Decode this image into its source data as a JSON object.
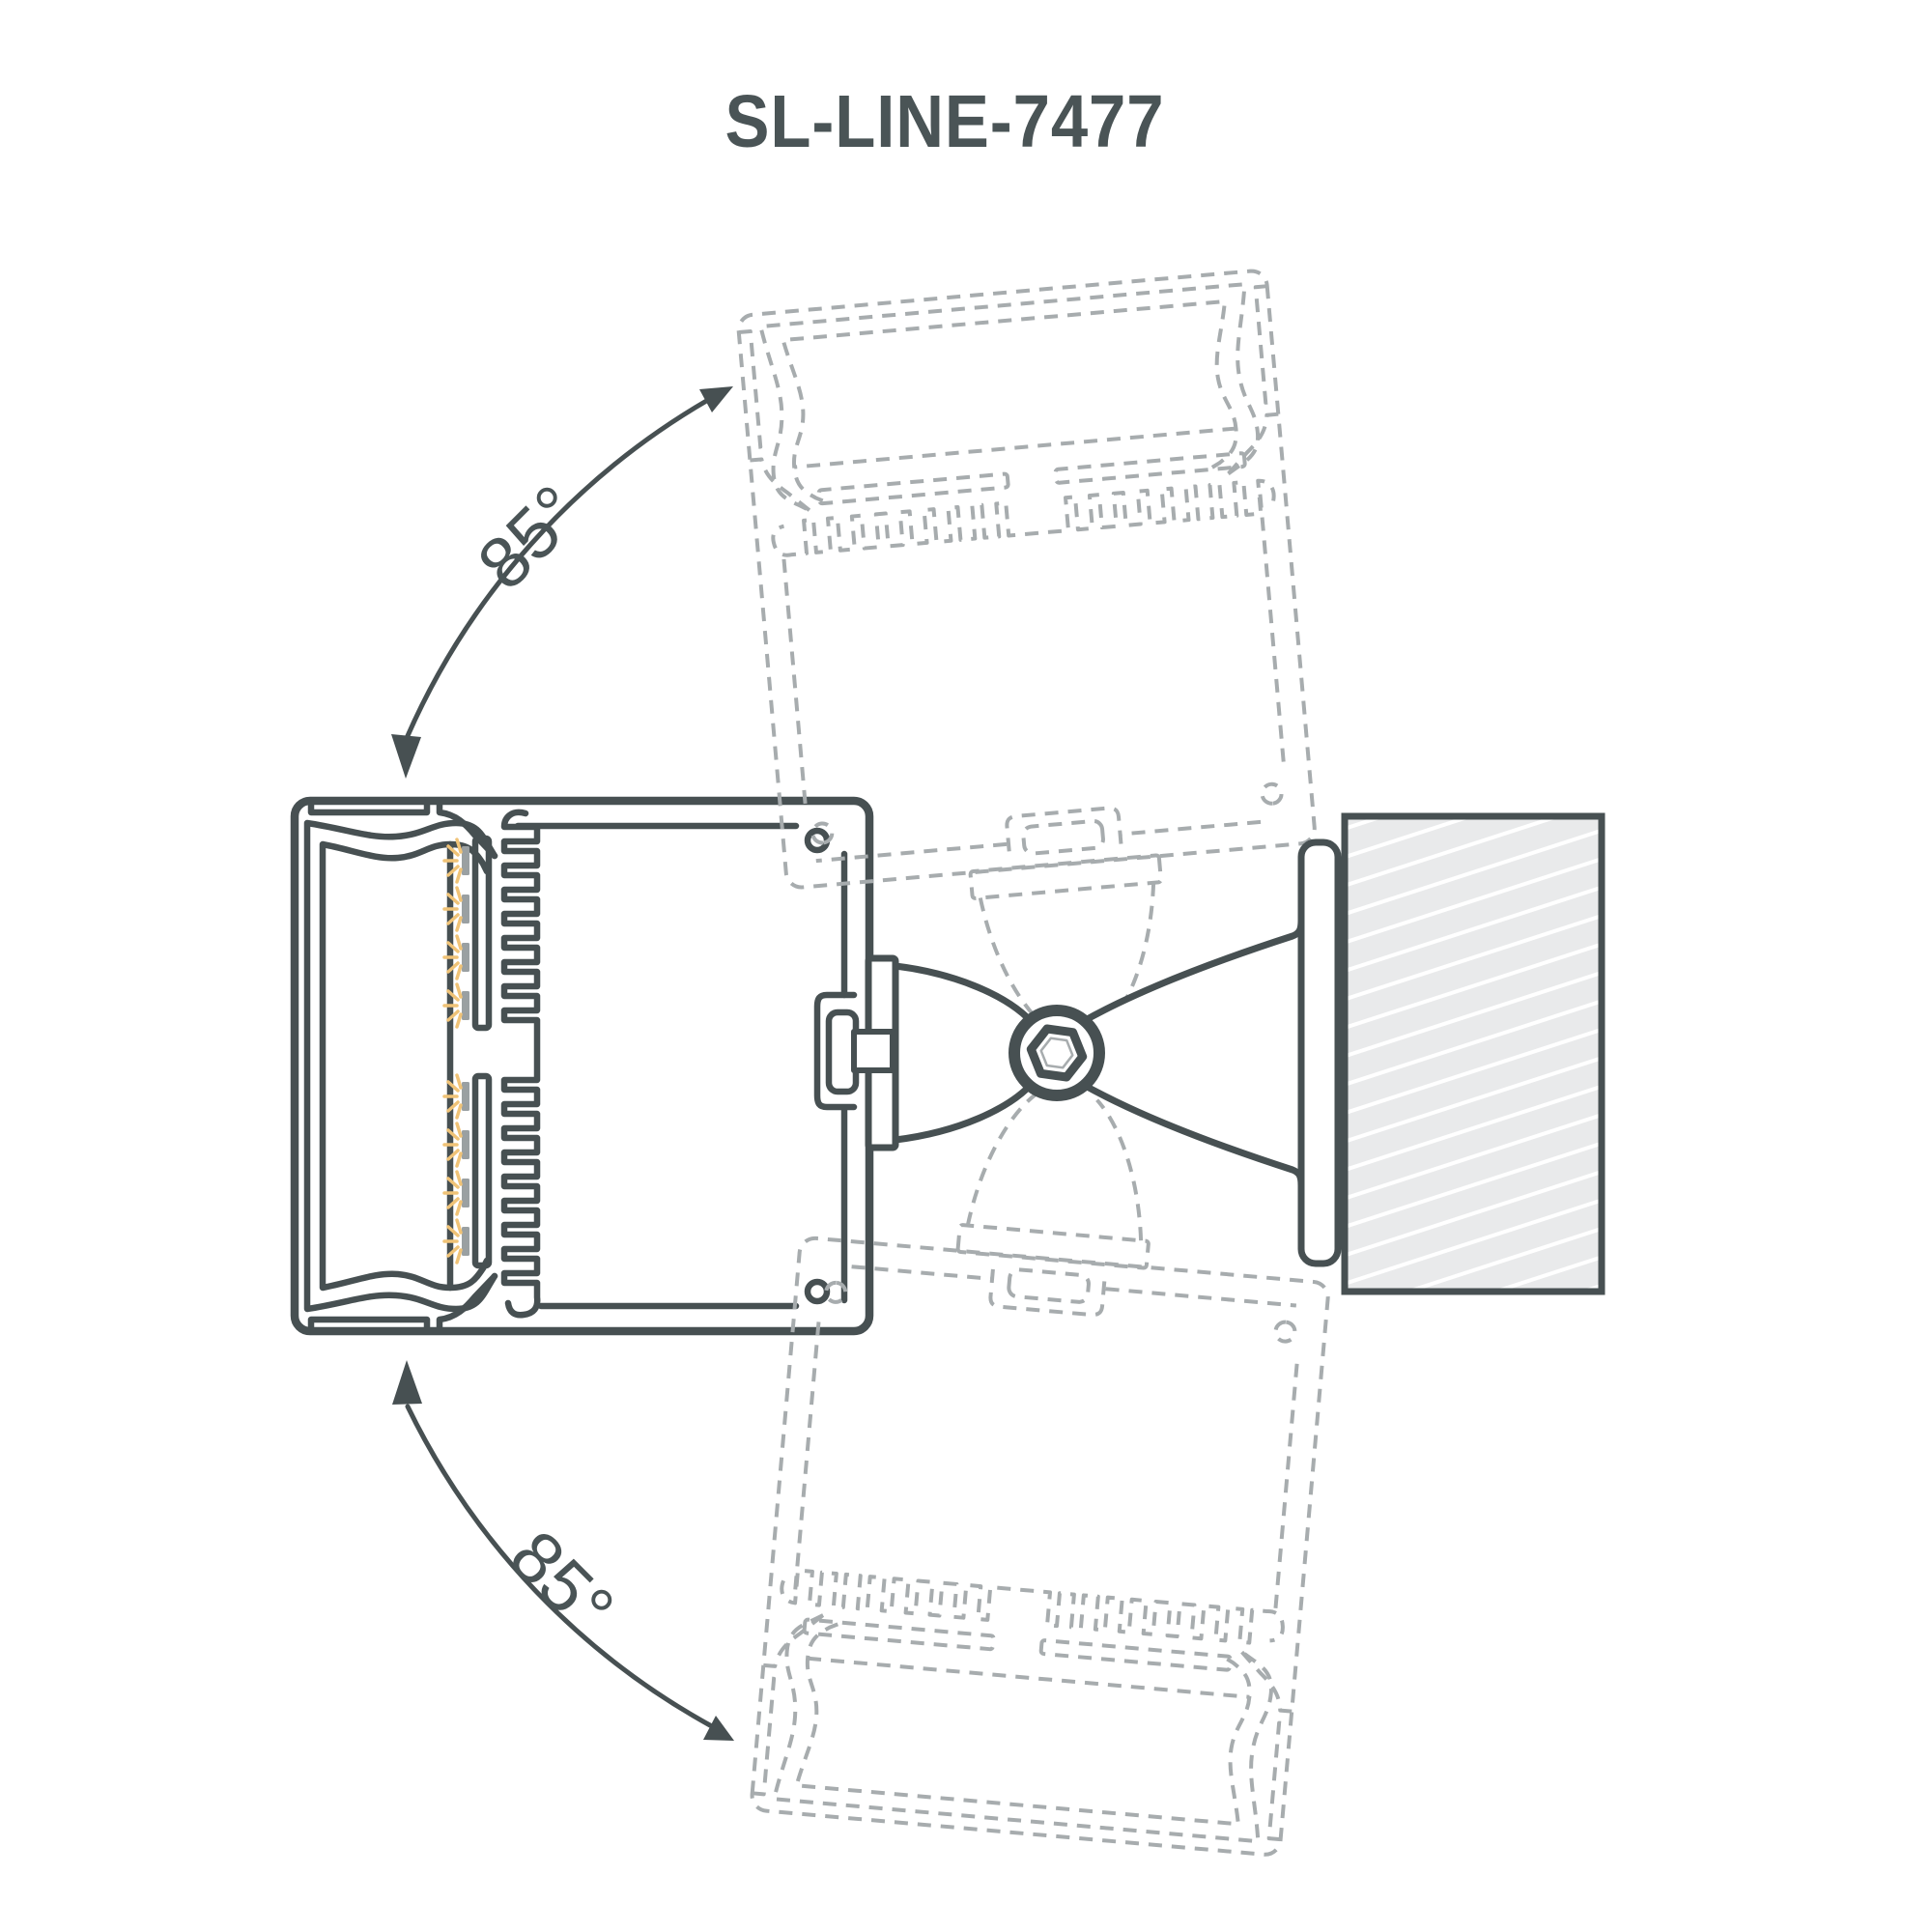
{
  "title": "SL-LINE-7477",
  "labels": {
    "upper_rotation": "85°",
    "lower_rotation": "85°"
  },
  "rotation": {
    "degrees": 85,
    "pivot_note": "hex screw pivot of wall bracket"
  },
  "colors": {
    "background": "#ffffff",
    "line": "#475052",
    "text": "#4a5456",
    "ghost": "#a7acae",
    "led_body": "#9aa0a2",
    "led_ray": "#f0c377",
    "wall_fill": "#e9eaeb",
    "wall_hatch": "#ffffff"
  }
}
